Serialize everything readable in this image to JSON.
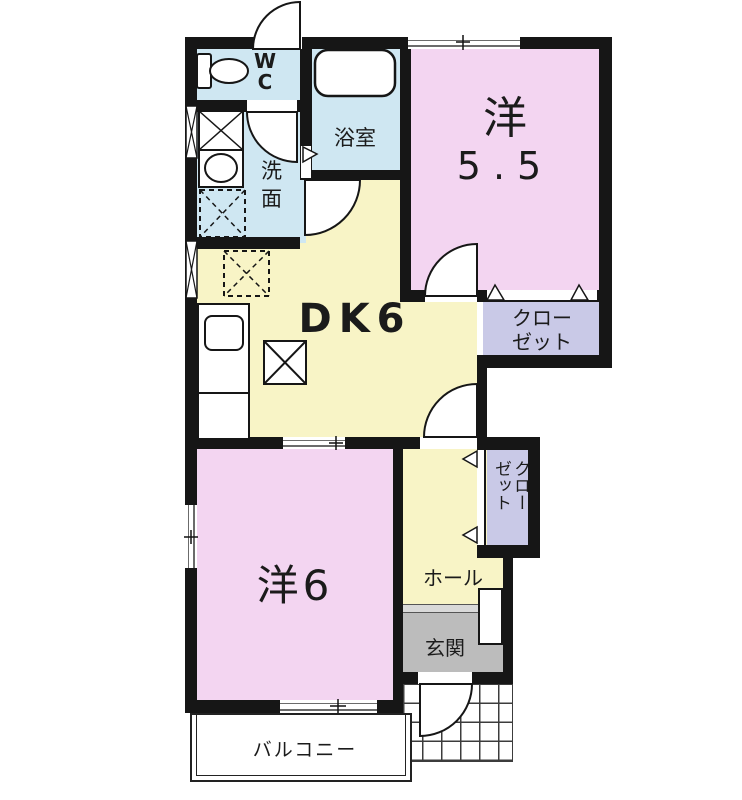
{
  "plan_title": "1DK apartment floor plan",
  "rooms": {
    "wc": {
      "label": "WC"
    },
    "bathroom": {
      "label": "浴室"
    },
    "washroom": {
      "label": "洗面"
    },
    "western_5_5": {
      "name": "洋",
      "size": "5.5"
    },
    "dining_kitchen": {
      "label": "DK6"
    },
    "closet_upper": {
      "line1": "クロー",
      "line2": "ゼット"
    },
    "closet_lower": {
      "label": "クローゼット"
    },
    "western_6": {
      "label": "洋6"
    },
    "hall": {
      "label": "ホール"
    },
    "entrance": {
      "label": "玄関"
    },
    "balcony": {
      "label": "バルコニー"
    }
  },
  "colors": {
    "wall": "#161616",
    "wet_area_blue": "#cfe7f2",
    "room_pink": "#f3d5f1",
    "dk_yellow": "#f8f4c6",
    "closet_lavender": "#c9c9e7",
    "entrance_gray": "#bcbcbc",
    "text": "#1b1b1b"
  },
  "legend": {
    "door_swing": "quarter-circle arc",
    "folding_door": "triangle marker",
    "window": "double thin line in wall",
    "appliance_space": "dashed X box",
    "tiled_porch": "grid pattern"
  }
}
